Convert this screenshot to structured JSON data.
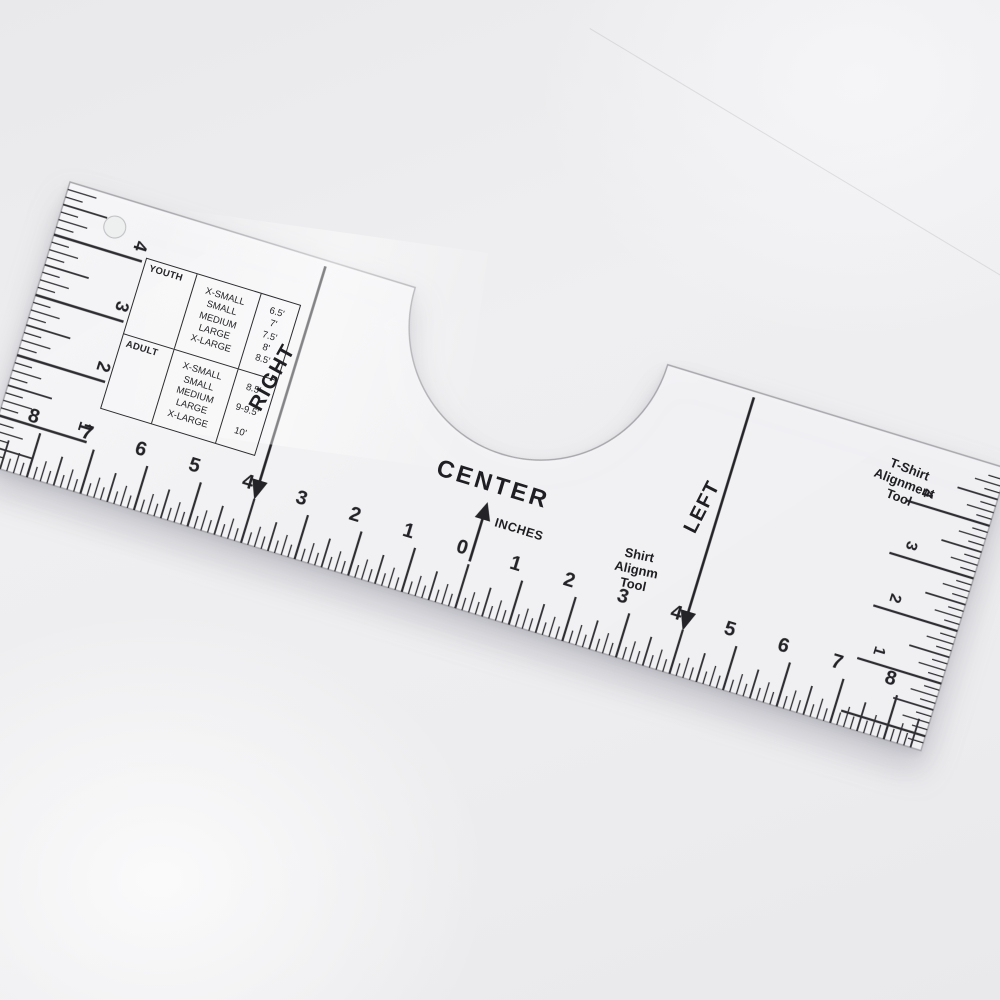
{
  "labels": {
    "center": "CENTER",
    "inches": "INCHES",
    "right": "RIGHT",
    "left": "LEFT",
    "shirt_tool": [
      "Shirt",
      "Alignm",
      "Tool"
    ],
    "tshirt_tool": [
      "T-Shirt",
      "Alignment",
      "Tool"
    ]
  },
  "size_chart": {
    "youth": {
      "label": "YOUTH",
      "sizes": [
        "X-SMALL",
        "SMALL",
        "MEDIUM",
        "LARGE",
        "X-LARGE"
      ],
      "values": [
        "6.5'",
        "7'",
        "7.5'",
        "8'",
        "8.5'"
      ]
    },
    "adult": {
      "label": "ADULT",
      "sizes": [
        "X-SMALL",
        "SMALL",
        "MEDIUM",
        "LARGE",
        "X-LARGE"
      ],
      "values": [
        "8.5'",
        "9-9.5'",
        "10'"
      ]
    }
  },
  "scales": {
    "bottom": {
      "unit": "inch",
      "numbers": [
        {
          "label": "8",
          "inch": -8
        },
        {
          "label": "7",
          "inch": -7
        },
        {
          "label": "6",
          "inch": -6
        },
        {
          "label": "5",
          "inch": -5
        },
        {
          "label": "4",
          "inch": -4
        },
        {
          "label": "3",
          "inch": -3
        },
        {
          "label": "2",
          "inch": -2
        },
        {
          "label": "1",
          "inch": -1
        },
        {
          "label": "0",
          "inch": 0
        },
        {
          "label": "1",
          "inch": 1
        },
        {
          "label": "2",
          "inch": 2
        },
        {
          "label": "3",
          "inch": 3
        },
        {
          "label": "4",
          "inch": 4
        },
        {
          "label": "5",
          "inch": 5
        },
        {
          "label": "6",
          "inch": 6
        },
        {
          "label": "7",
          "inch": 7
        },
        {
          "label": "8",
          "inch": 8
        }
      ]
    },
    "left_edge": {
      "numbers": [
        "4",
        "3",
        "2",
        "1"
      ]
    },
    "right_edge": {
      "numbers": [
        "4",
        "3",
        "2",
        "1"
      ]
    }
  },
  "colors": {
    "ink": "#232327",
    "tick": "#2e2e32",
    "ruler_fill": "#f5f5f7",
    "ruler_edge": "#a6a6ab",
    "background": "#ebebed"
  }
}
